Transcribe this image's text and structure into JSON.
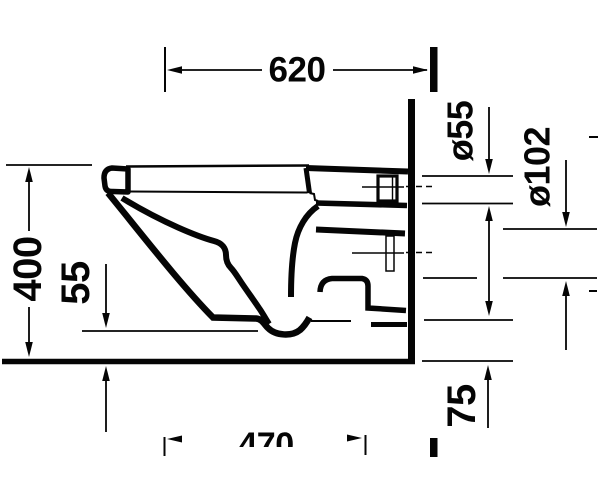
{
  "drawing": {
    "title": "wall-hung toilet side-view installation dimension drawing",
    "unit": "mm",
    "line_color": "#050505",
    "background_color": "#ffffff",
    "dimensions": {
      "total_depth": "620",
      "flush_pipe_diameter": "ø55",
      "outlet_pipe_diameter": "ø102",
      "rim_height": "400",
      "bowl_bottom_clearance": "55",
      "outlet_offset": "75",
      "partial_depth": "470"
    }
  }
}
